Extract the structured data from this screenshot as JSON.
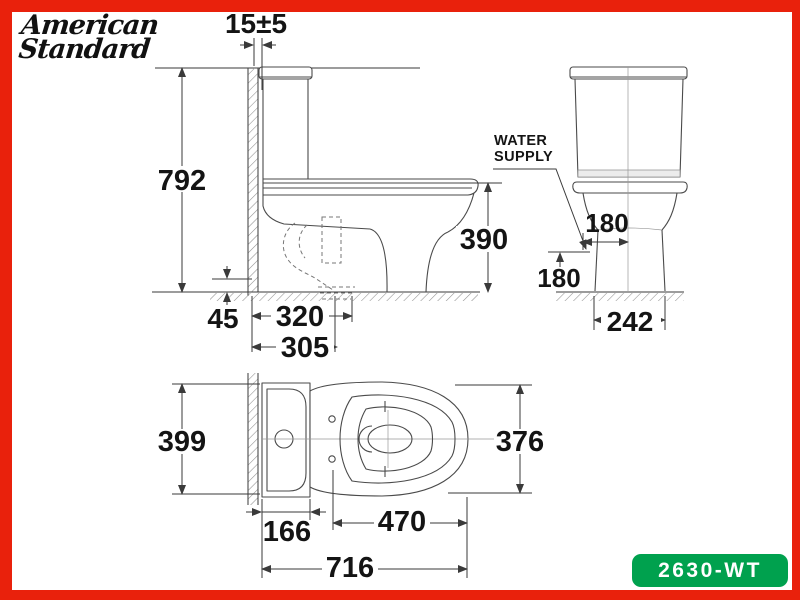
{
  "brand": {
    "name_line1": "American",
    "name_line2": "Standard"
  },
  "badge": {
    "model": "2630-WT"
  },
  "colors": {
    "frame_red": "#e9210c",
    "badge_green": "#00a14e",
    "ink": "#141414",
    "line": "#4a4a4a"
  },
  "side_view": {
    "dims": {
      "wall_gap": "15±5",
      "total_height": "792",
      "rim_height": "390",
      "outlet_offset": "45",
      "rough_in_outer": "320",
      "rough_in": "305"
    }
  },
  "front_view": {
    "water_supply_line1": "WATER",
    "water_supply_line2": "SUPPLY",
    "dims": {
      "supply_offset": "180",
      "supply_height": "180",
      "base_width": "242"
    }
  },
  "top_view": {
    "dims": {
      "tank_width": "399",
      "bowl_width": "376",
      "tank_depth": "166",
      "seat_length": "470",
      "total_length": "716"
    }
  }
}
